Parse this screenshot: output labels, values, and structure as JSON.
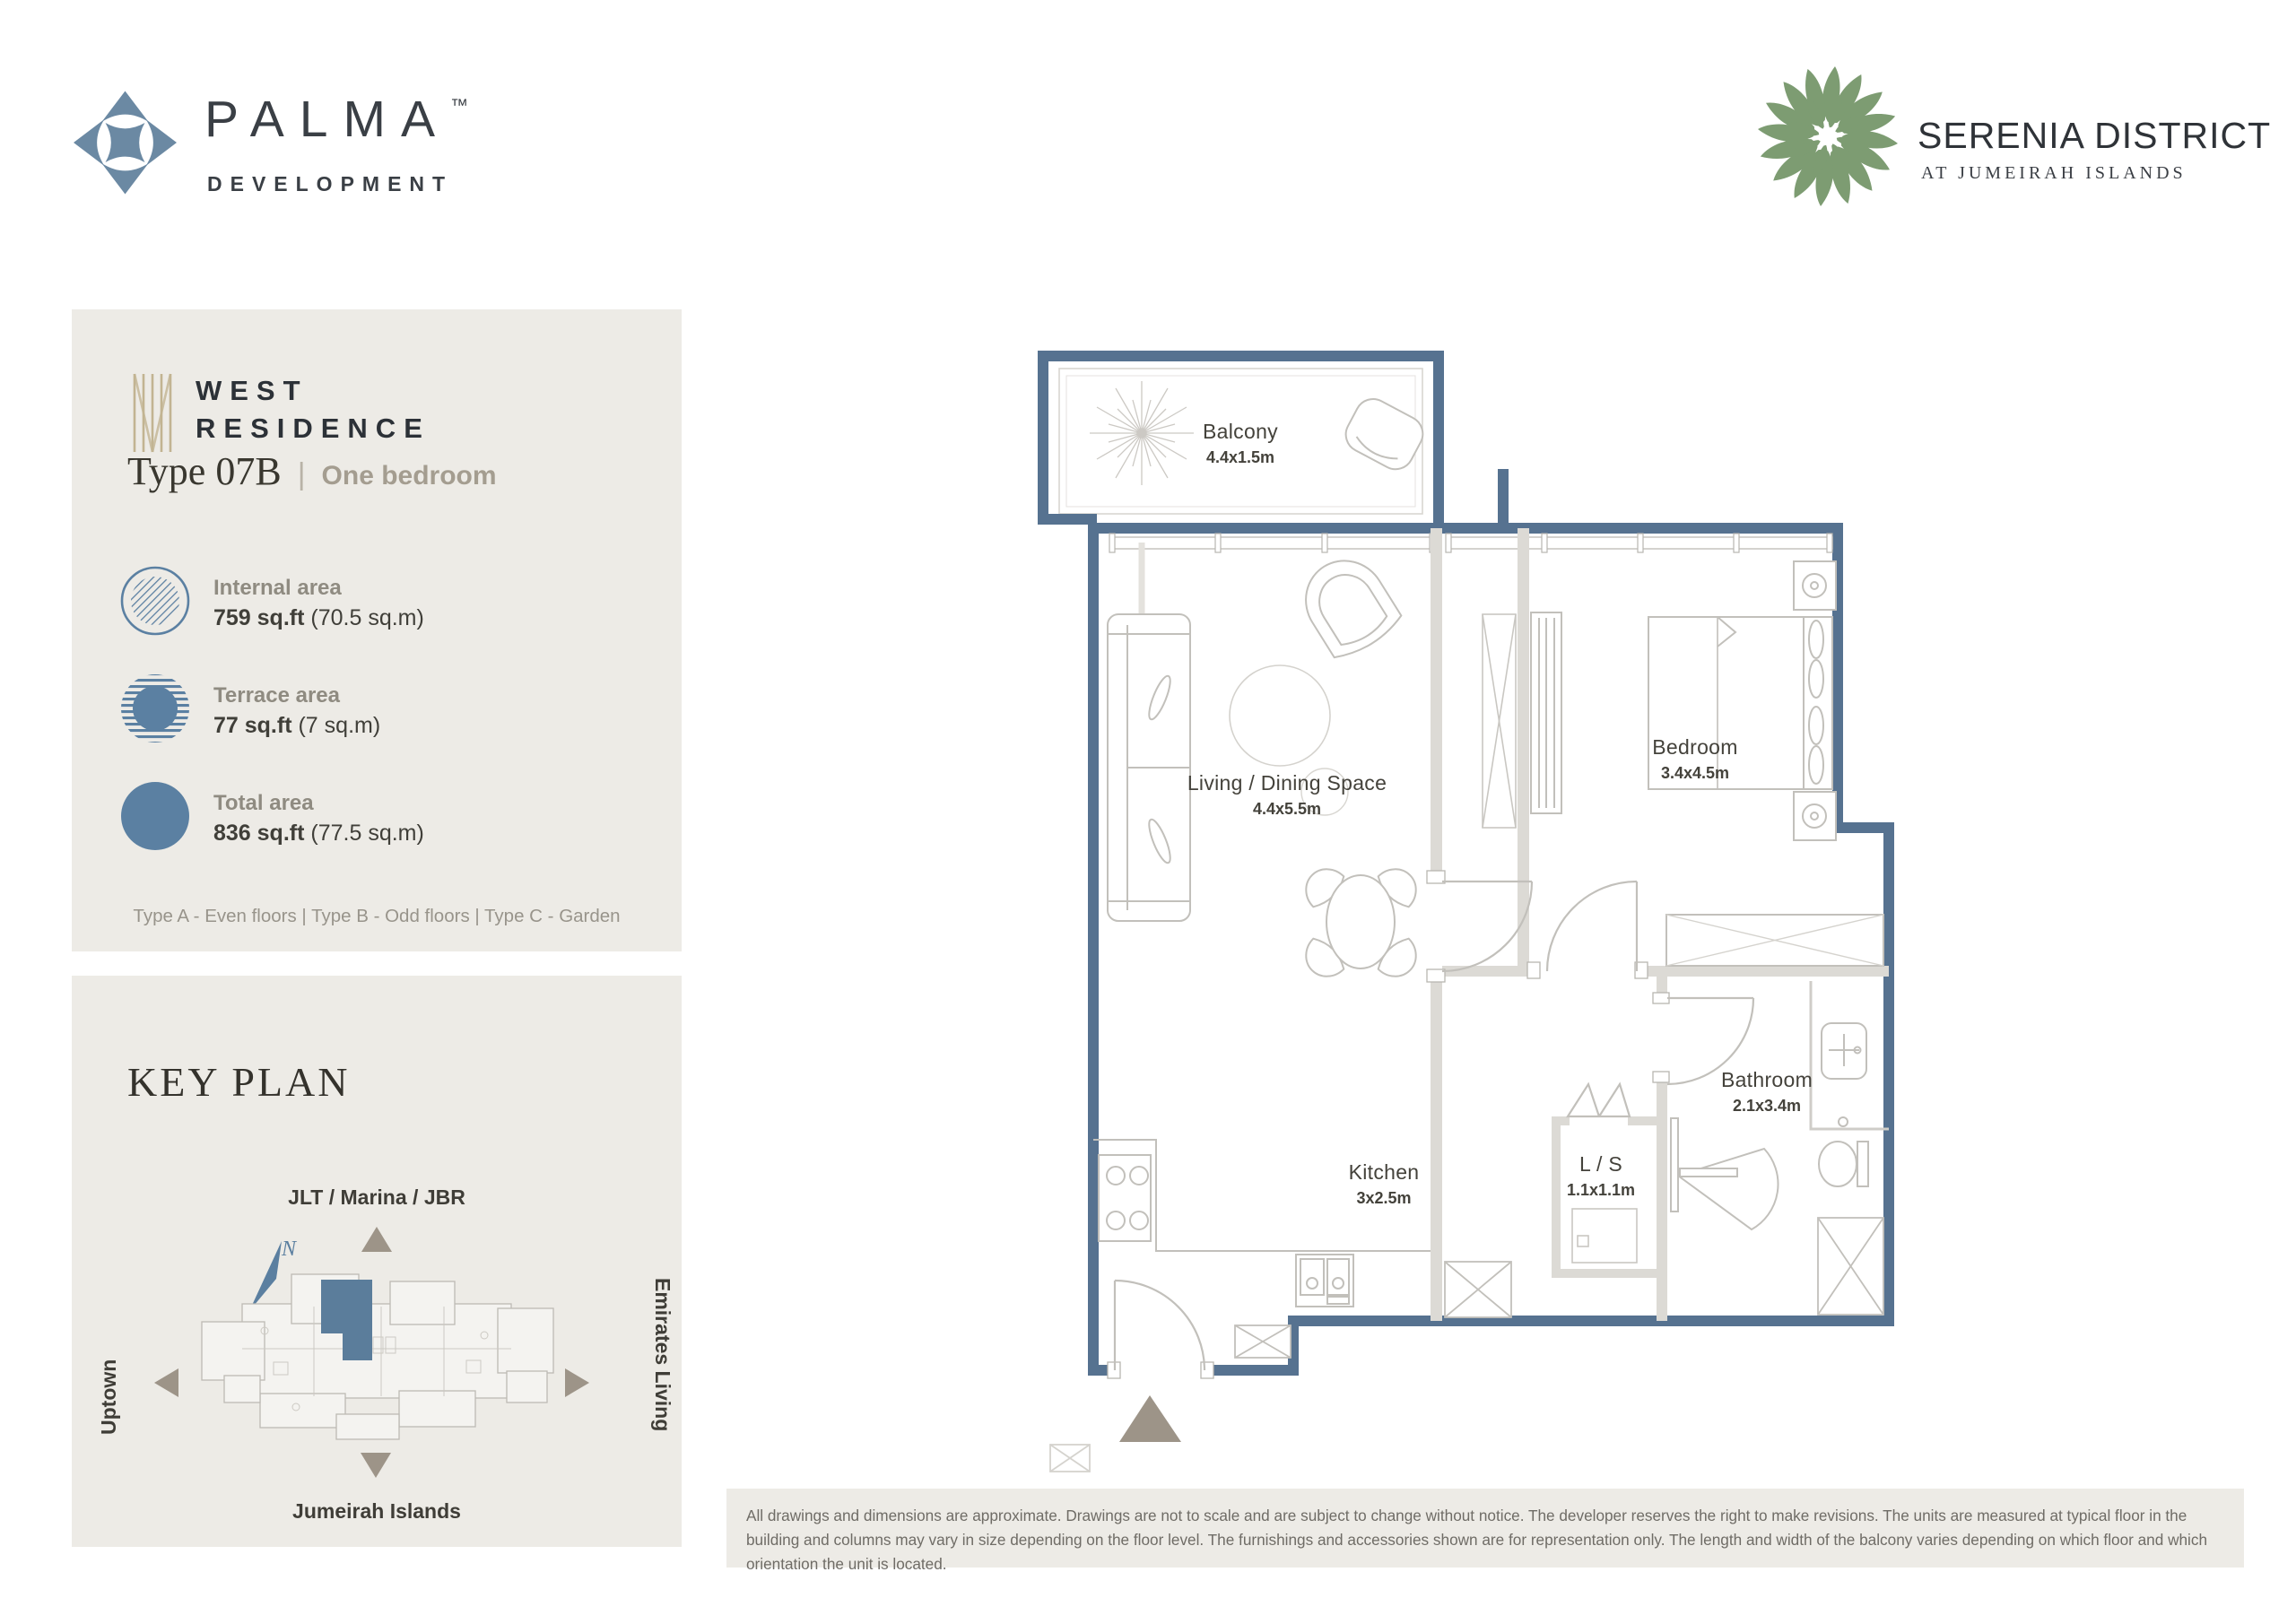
{
  "header": {
    "brand": {
      "name": "PALMA",
      "tm": "™",
      "subtitle": "DEVELOPMENT"
    },
    "project": {
      "name": "SERENIA DISTRICT",
      "subtitle": "AT JUMEIRAH ISLANDS"
    }
  },
  "info_panel": {
    "residence_line1": "WEST",
    "residence_line2": "RESIDENCE",
    "unit_type": "Type 07B",
    "separator": "|",
    "bedrooms": "One bedroom",
    "areas": [
      {
        "label": "Internal area",
        "value": "759 sq.ft",
        "metric": "(70.5 sq.m)",
        "icon": "hatched-circle-icon"
      },
      {
        "label": "Terrace area",
        "value": "77 sq.ft",
        "metric": "(7 sq.m)",
        "icon": "striped-circle-icon"
      },
      {
        "label": "Total area",
        "value": "836 sq.ft",
        "metric": "(77.5 sq.m)",
        "icon": "solid-circle-icon"
      }
    ],
    "floor_note": "Type A - Even floors | Type B - Odd floors | Type C - Garden"
  },
  "key_plan": {
    "title": "KEY PLAN",
    "north_label": "N",
    "directions": {
      "top": "JLT / Marina / JBR",
      "left": "Uptown",
      "right": "Emirates Living",
      "bottom": "Jumeirah Islands"
    }
  },
  "floor_plan": {
    "rooms": [
      {
        "name": "Balcony",
        "dimensions": "4.4x1.5m"
      },
      {
        "name": "Living / Dining Space",
        "dimensions": "4.4x5.5m"
      },
      {
        "name": "Bedroom",
        "dimensions": "3.4x4.5m"
      },
      {
        "name": "Kitchen",
        "dimensions": "3x2.5m"
      },
      {
        "name": "L / S",
        "dimensions": "1.1x1.1m"
      },
      {
        "name": "Bathroom",
        "dimensions": "2.1x3.4m"
      }
    ]
  },
  "disclaimer": "All drawings and dimensions are approximate. Drawings are not to scale and are subject to change without notice. The developer reserves the right to make revisions. The units are measured at typical floor in the building and columns may vary in size depending on the floor level. The furnishings and accessories shown are for representation only. The length and width of the balcony varies depending on which floor and which orientation the unit is located.",
  "colors": {
    "wall_blue": "#567290",
    "accent_blue": "#5b80a2",
    "keyplan_unit_blue": "#5b7d9b",
    "panel_bg": "#edebe6",
    "taupe": "#9d9488",
    "logo_green": "#7d9c72"
  }
}
